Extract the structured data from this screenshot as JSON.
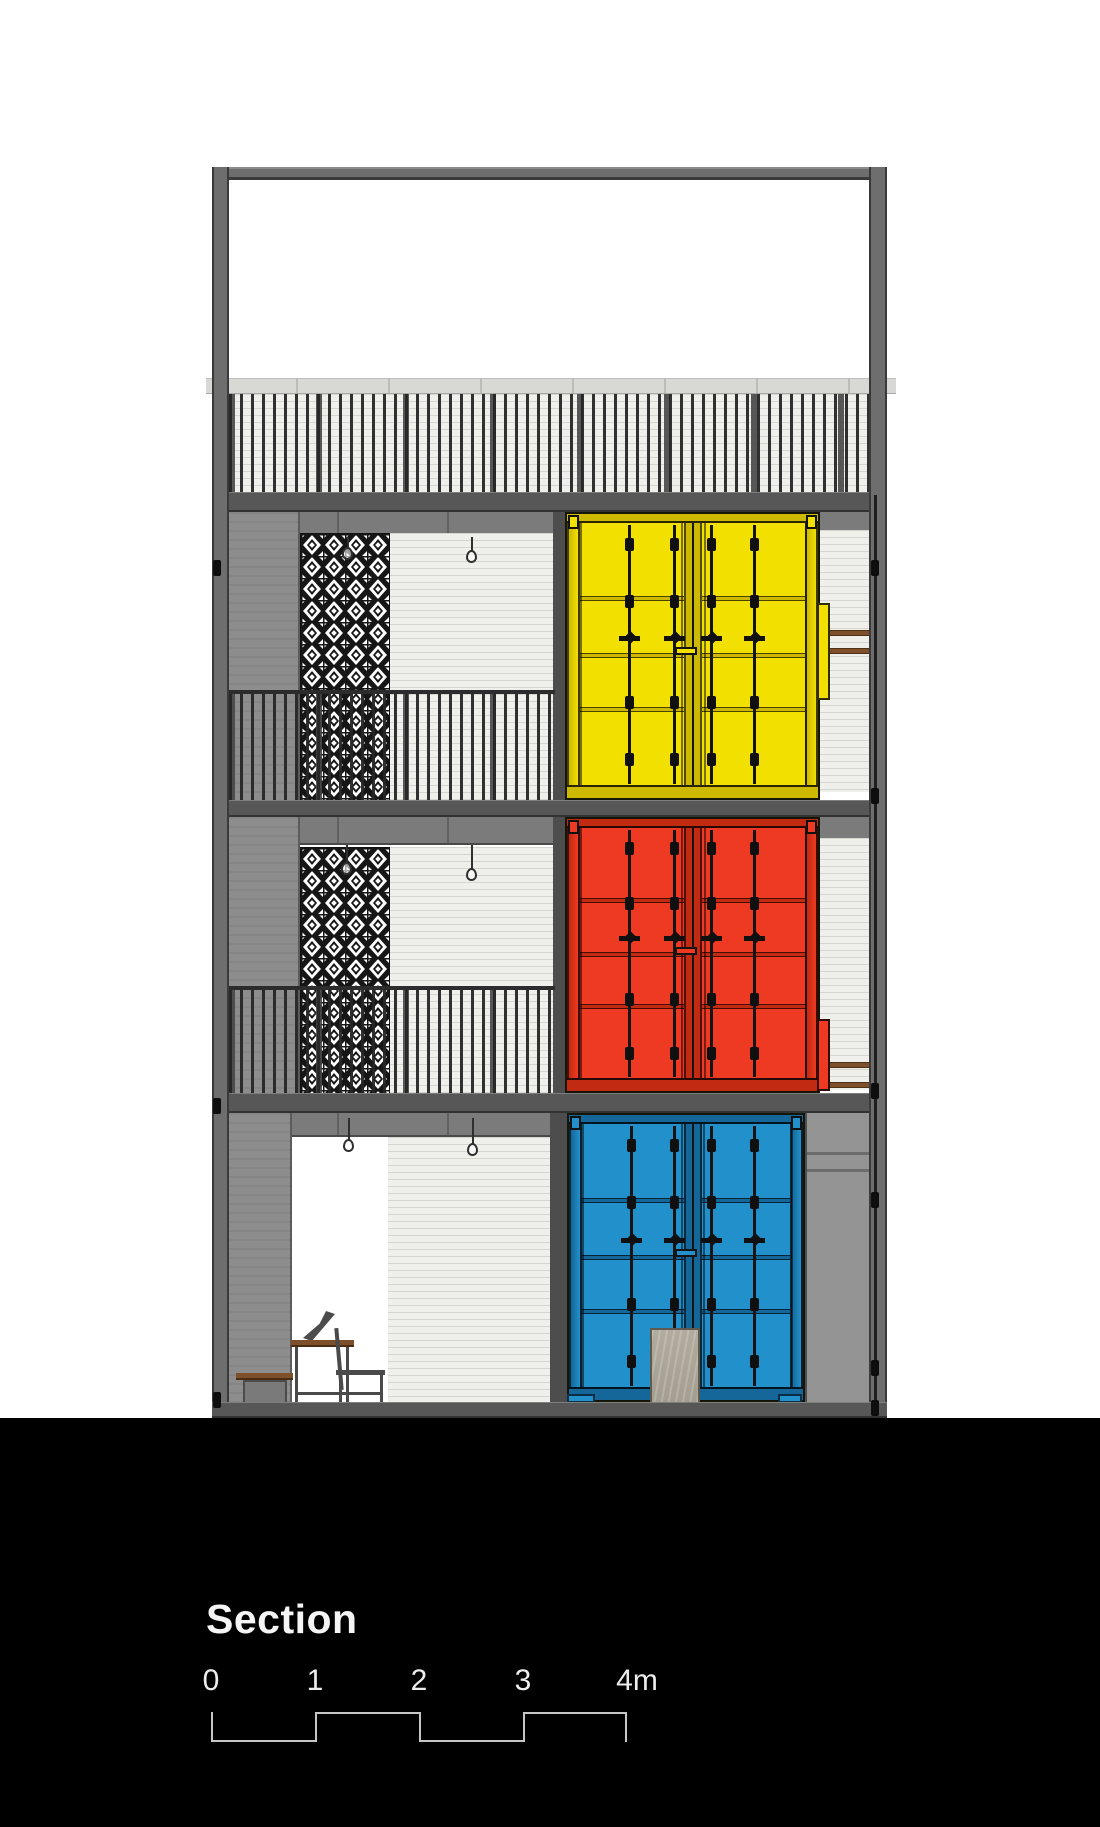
{
  "title": {
    "label": "Section"
  },
  "scale_bar": {
    "tick_labels": [
      "0",
      "1",
      "2",
      "3",
      "4m"
    ],
    "unit": "m",
    "segments": 4
  },
  "drawing": {
    "type": "architectural-section-elevation",
    "containers": [
      {
        "position": "third-floor",
        "color_name": "yellow",
        "color": "#f2e000"
      },
      {
        "position": "second-floor",
        "color_name": "red",
        "color": "#ee3a22"
      },
      {
        "position": "ground-floor",
        "color_name": "blue",
        "color": "#2290ca"
      }
    ]
  },
  "palette": {
    "bg": "#ffffff",
    "ground": "#000000",
    "frame": "#6e6e6e",
    "frame-edge": "#3a3a3a",
    "slab": "#575757",
    "beam": "#7b7b7b",
    "beam-joint": "#616161",
    "cap": "#d8d8d4",
    "cutwall": "#8d8d8d",
    "rwall": "#949494",
    "darkcol": "#4d4d4d",
    "brick": "#efefec",
    "brick-line": "#d6d6d1",
    "container-yellow": "#f2e000",
    "container-yellow-dark": "#cdb900",
    "container-red": "#ee3a22",
    "container-red-dark": "#c22a12",
    "container-blue": "#2290ca",
    "container-blue-dark": "#15679a",
    "wood": "#7d4f2b",
    "text": "#f5f5f5",
    "scale-line": "#c6c6c6"
  }
}
